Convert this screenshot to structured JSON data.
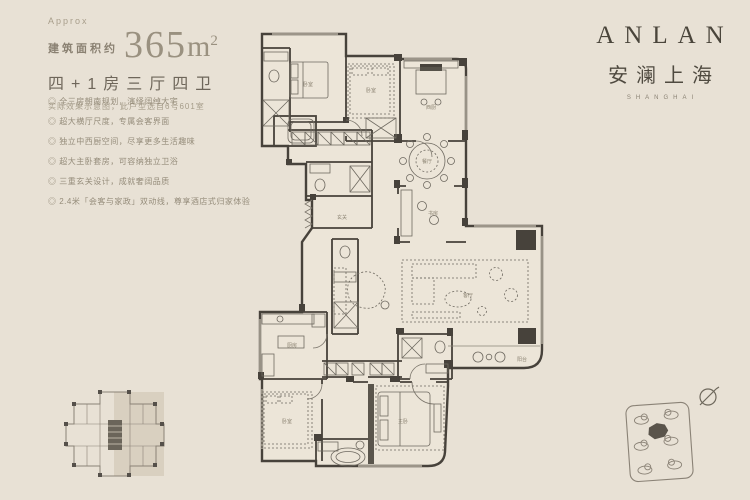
{
  "header": {
    "approx": "Approx",
    "area_label": "建筑面积约",
    "area_value": "365",
    "area_unit": "m",
    "area_sup": "2",
    "layout": "四+1房三厅四卫",
    "disclaimer": "实际效果示意图，此户型选自6号601室"
  },
  "features": [
    "◎ 全三房朝南规划，演绎阔绰大宅",
    "◎ 超大横厅尺度，专属会客界面",
    "◎ 独立中西厨空间，尽享更多生活趣味",
    "◎ 超大主卧套房，可容纳独立卫浴",
    "◎ 三重玄关设计，成就奢阔品质",
    "◎ 2.4米「会客与家政」双动线，尊享酒店式归家体验"
  ],
  "brand": {
    "name": "ANLAN",
    "cn": "安澜上海",
    "sub": "SHANGHAI"
  },
  "plan": {
    "labels": [
      "卧室",
      "卧室",
      "西厨",
      "餐厅",
      "书房",
      "客厅",
      "玄关",
      "厨房",
      "卧室",
      "主卧",
      "阳台"
    ]
  },
  "colors": {
    "background": "#e8e1d5",
    "wall": "#47423b",
    "text_primary": "#6e665a",
    "text_muted": "#a69d8a",
    "brand": "#4a453b"
  }
}
